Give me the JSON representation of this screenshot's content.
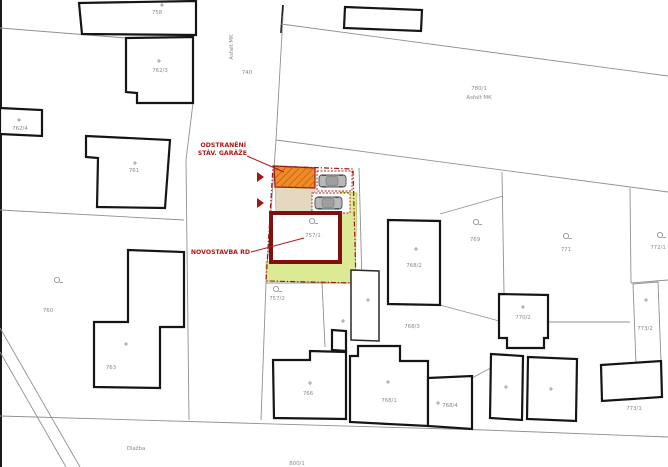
{
  "plan": {
    "annotations": {
      "removal_line1": "ODSTRANĚNÍ",
      "removal_line2": "STÁV. GARÁŽE",
      "new_house": "NOVOSTAVBA RD"
    },
    "roads": {
      "west_street_surface": "Asfalt MK",
      "west_street_parcel": "740",
      "north_street_parcel": "780/1",
      "north_street_surface": "Asfalt MK",
      "south_street_surface": "Dlažba",
      "south_street_parcel": "800/1"
    },
    "parcels": {
      "p758": "758",
      "p762_3": "762/3",
      "p762_4": "762/4",
      "p761": "761",
      "p760": "760",
      "p763": "763",
      "p757_1": "757/1",
      "p757_2": "757/2",
      "p766": "766",
      "p768_1": "768/1",
      "p768_2": "768/2",
      "p768_3": "768/3",
      "p768_4": "768/4",
      "p769": "769",
      "p771": "771",
      "p772_1": "772/1",
      "p770_2": "770/2",
      "p773_1": "773/1",
      "p773_2": "773/2"
    },
    "colors": {
      "annotation_red": "#b01818",
      "house_outline_red": "#7e1010",
      "boundary_red": "#a31515",
      "garage_orange": "#ef8b28",
      "garage_border": "#8a1a1a",
      "yard_beige": "#e6d8c0",
      "yard_beige_border": "#b3a184",
      "garden_green": "#dcea96",
      "garden_green_border": "#a9bf55",
      "label_gray": "#8a8a8a"
    }
  }
}
